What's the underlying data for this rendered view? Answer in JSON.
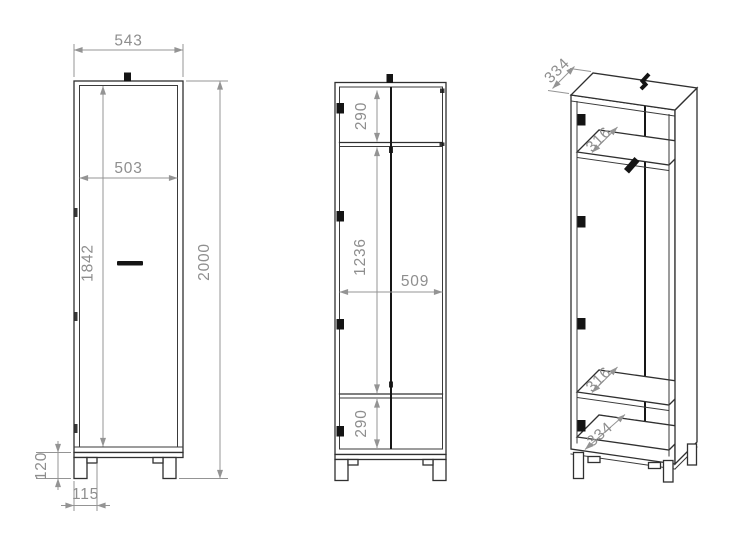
{
  "drawing": {
    "kind": "furniture technical drawing - tall wardrobe cabinet, three views",
    "colors": {
      "background": "#ffffff",
      "outline": "#303030",
      "dimension": "#8e8e8e",
      "hardware": "#141414"
    }
  },
  "views": {
    "front_closed": {
      "name": "front view, door closed",
      "dims": {
        "overall_width": "543",
        "door_width": "503",
        "door_height": "1842",
        "overall_height": "2000",
        "leg_height": "120",
        "leg_inset": "115"
      }
    },
    "front_open": {
      "name": "front view, interior",
      "dims": {
        "top_compartment": "290",
        "middle_section": "1236",
        "interior_width": "509",
        "bottom_compartment": "290"
      }
    },
    "isometric": {
      "name": "isometric view, interior",
      "dims": {
        "top_depth": "334",
        "upper_shelf_depth": "316",
        "lower_shelf_depth": "316",
        "bottom_depth": "334"
      }
    }
  }
}
